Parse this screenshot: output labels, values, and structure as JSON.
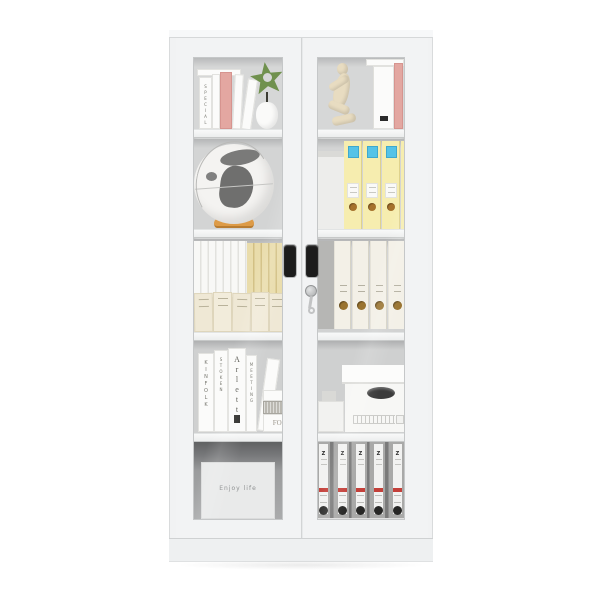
{
  "left_door": {
    "panel_text": "Enjoy life"
  },
  "shelf_top_left": {
    "book_spine": "SPECIAL ISSUE"
  },
  "shelf4_books": {
    "book1": "KINFOLK",
    "book2": "STOKEN",
    "book3": "Arletta",
    "book4": "MEETING",
    "stack_book": "FOL"
  },
  "bottom_binders": {
    "b1": "Z",
    "b2": "Z",
    "b3": "Z",
    "b4": "Z",
    "b5": "Z"
  },
  "colors": {
    "cabinet_white": "#f2f3f4",
    "interior_gray": "#d4d5d5",
    "folder_yellow": "#f6edaf",
    "label_blue": "#55c3e7",
    "plant_green": "#70914e",
    "book_pink": "#e3a7a1",
    "wood_orange": "#dd9b47",
    "binder_red": "#c4403a",
    "handle_black": "#1c1c1c"
  }
}
